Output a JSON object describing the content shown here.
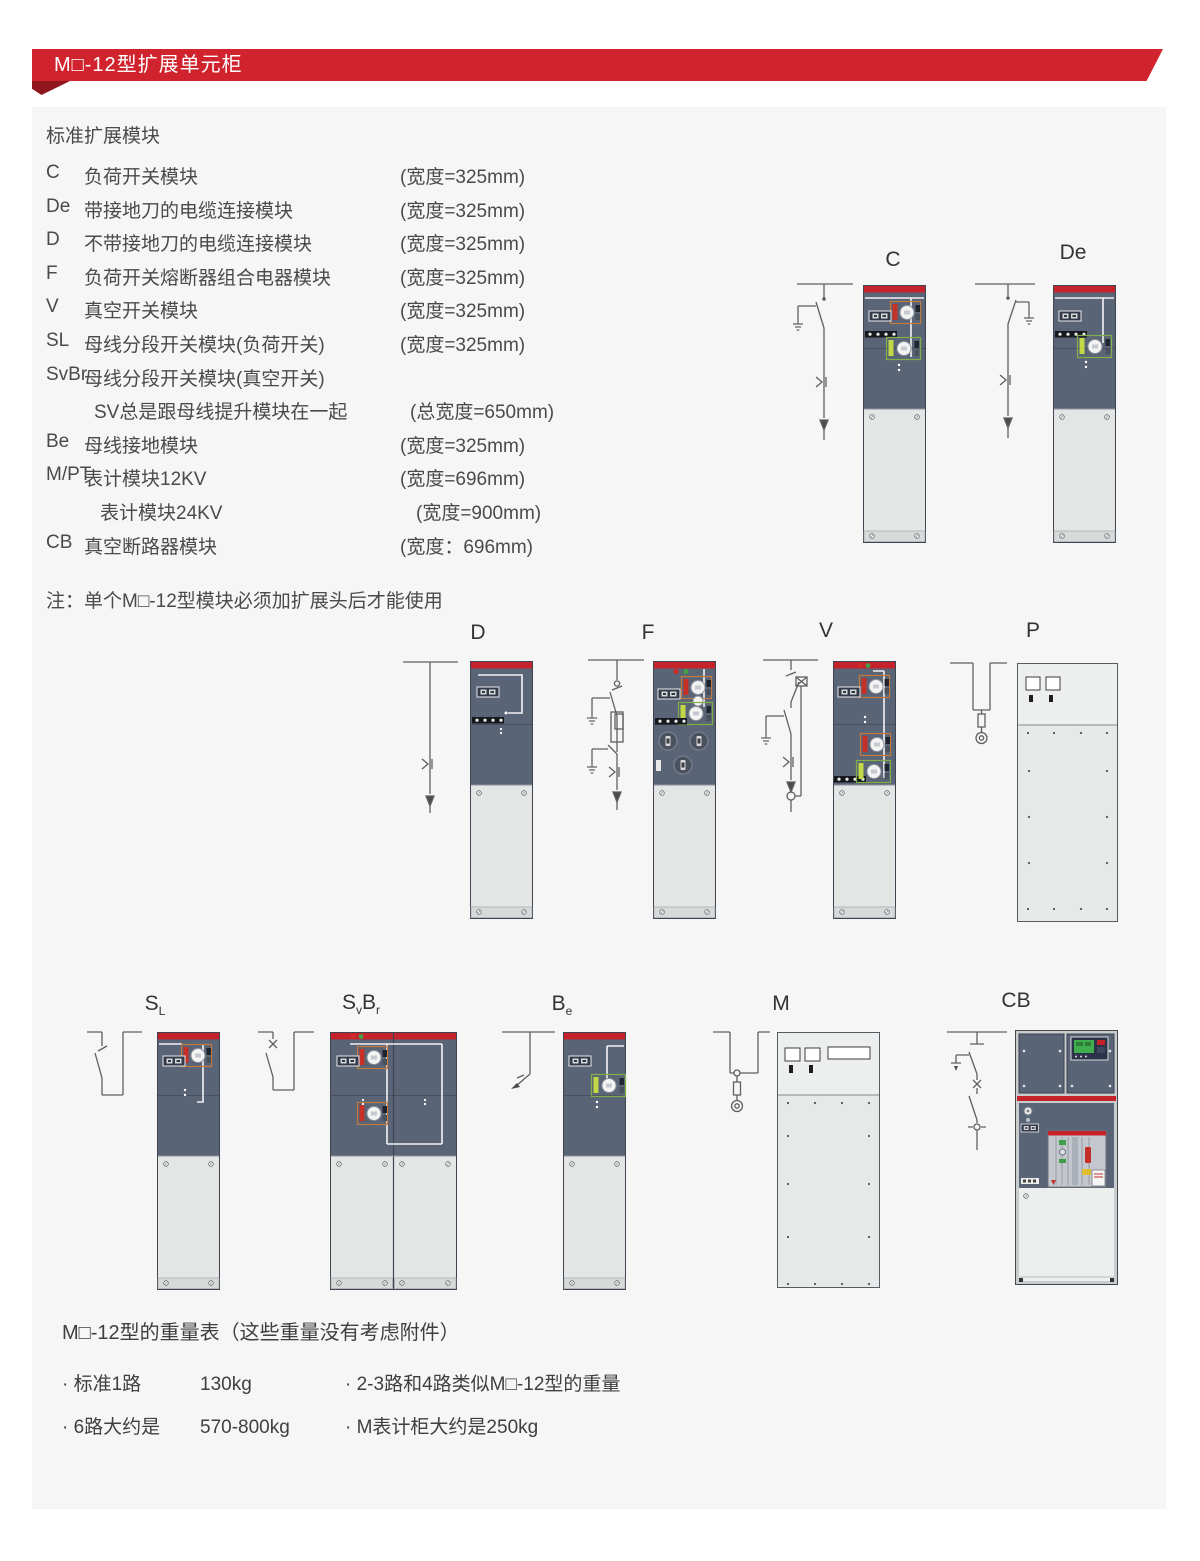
{
  "header": {
    "title": "M□-12型扩展单元柜"
  },
  "modules": {
    "section_title": "标准扩展模块",
    "items": [
      {
        "code": "C",
        "name": "负荷开关模块",
        "width": "(宽度=325mm)"
      },
      {
        "code": "De",
        "name": "带接地刀的电缆连接模块",
        "width": "(宽度=325mm)"
      },
      {
        "code": "D",
        "name": "不带接地刀的电缆连接模块",
        "width": "(宽度=325mm)"
      },
      {
        "code": "F",
        "name": "负荷开关熔断器组合电器模块",
        "width": "(宽度=325mm)"
      },
      {
        "code": "V",
        "name": "真空开关模块",
        "width": "(宽度=325mm)"
      },
      {
        "code": "SL",
        "name": "母线分段开关模块(负荷开关)",
        "width": "(宽度=325mm)"
      },
      {
        "code": "SvBr",
        "name": "母线分段开关模块(真空开关)",
        "width": ""
      },
      {
        "code": "",
        "name": "SV总是跟母线提升模块在一起",
        "width": "(总宽度=650mm)"
      },
      {
        "code": "Be",
        "name": "母线接地模块",
        "width": "(宽度=325mm)"
      },
      {
        "code": "M/PT",
        "name": "表计模块12KV",
        "width": "(宽度=696mm)"
      },
      {
        "code": "",
        "name": "表计模块24KV",
        "width": "(宽度=900mm)"
      },
      {
        "code": "CB",
        "name": "真空断路器模块",
        "width": "(宽度：696mm)"
      }
    ],
    "note": "注：单个M□-12型模块必须加扩展头后才能使用"
  },
  "diagrams": {
    "c": {
      "label": "C"
    },
    "de": {
      "label": "De"
    },
    "d": {
      "label": "D"
    },
    "f": {
      "label": "F"
    },
    "v": {
      "label": "V"
    },
    "p": {
      "label": "P"
    },
    "sl": {
      "main": "S",
      "sub": "L"
    },
    "svbr": {
      "main1": "S",
      "sub1": "v",
      "main2": "B",
      "sub2": "r"
    },
    "be": {
      "main": "B",
      "sub": "e"
    },
    "m": {
      "label": "M"
    },
    "cb": {
      "label": "CB"
    }
  },
  "weights": {
    "title": "M□-12型的重量表（这些重量没有考虑附件）",
    "items": [
      {
        "label": "· 标准1路",
        "value": "130kg"
      },
      {
        "label": "· 2-3路和4路类似M□-12型的重量",
        "value": ""
      },
      {
        "label": "· 6路大约是",
        "value": "570-800kg"
      },
      {
        "label": "· M表计柜大约是250kg",
        "value": ""
      }
    ]
  },
  "colors": {
    "banner_red": "#d0232e",
    "banner_fold_red": "#8f161d",
    "cabinet_stripe_red": "#c4232b",
    "cabinet_dark": "#5a6477",
    "cabinet_light": "#e4e6e5",
    "content_bg": "#f5f6f5",
    "text": "#4a4a4a"
  }
}
